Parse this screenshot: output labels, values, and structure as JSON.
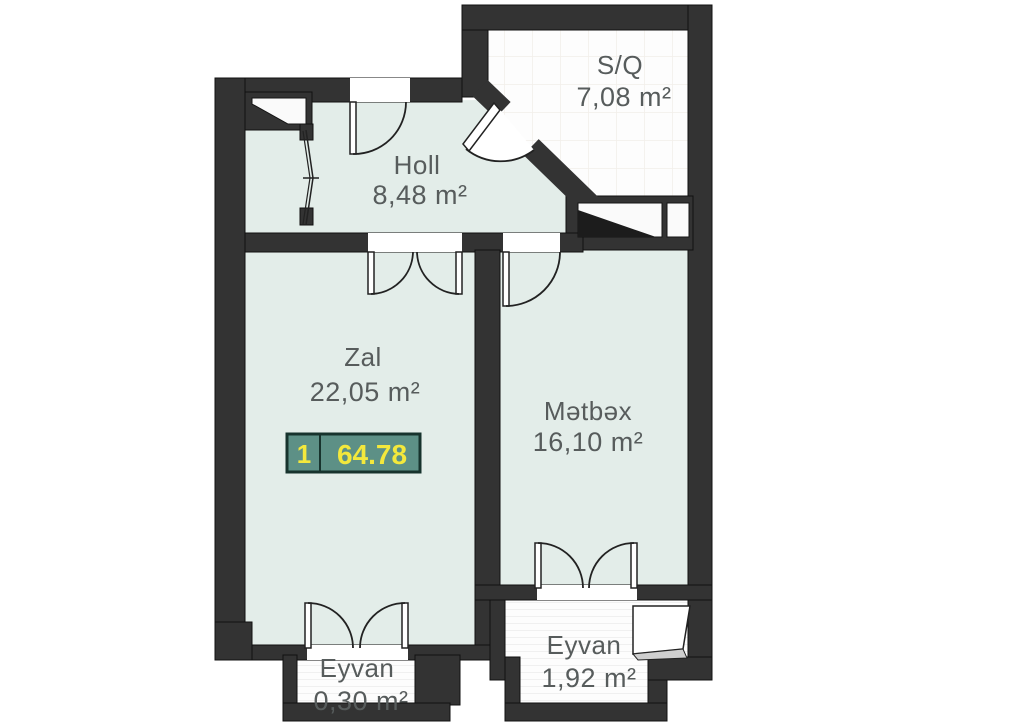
{
  "floorplan": {
    "rooms": [
      {
        "id": "sq",
        "name": "S/Q",
        "area": "7,08 m²"
      },
      {
        "id": "holl",
        "name": "Holl",
        "area": "8,48 m²"
      },
      {
        "id": "zal",
        "name": "Zal",
        "area": "22,05 m²"
      },
      {
        "id": "metbex",
        "name": "Mətbəx",
        "area": "16,10 m²"
      },
      {
        "id": "eyvan-small",
        "name": "Eyvan",
        "area": "0,30 m²"
      },
      {
        "id": "eyvan-large",
        "name": "Eyvan",
        "area": "1,92 m²"
      }
    ],
    "unit_badge": {
      "number": "1",
      "total_area": "64.78"
    },
    "colors": {
      "wall": "#333333",
      "floor_mint": "#e3ede9",
      "floor_light": "#fdfdfd",
      "badge_bg": "#5d9086",
      "badge_border": "#17332d",
      "badge_text": "#f3e83c",
      "label_text": "#575c5c"
    }
  }
}
